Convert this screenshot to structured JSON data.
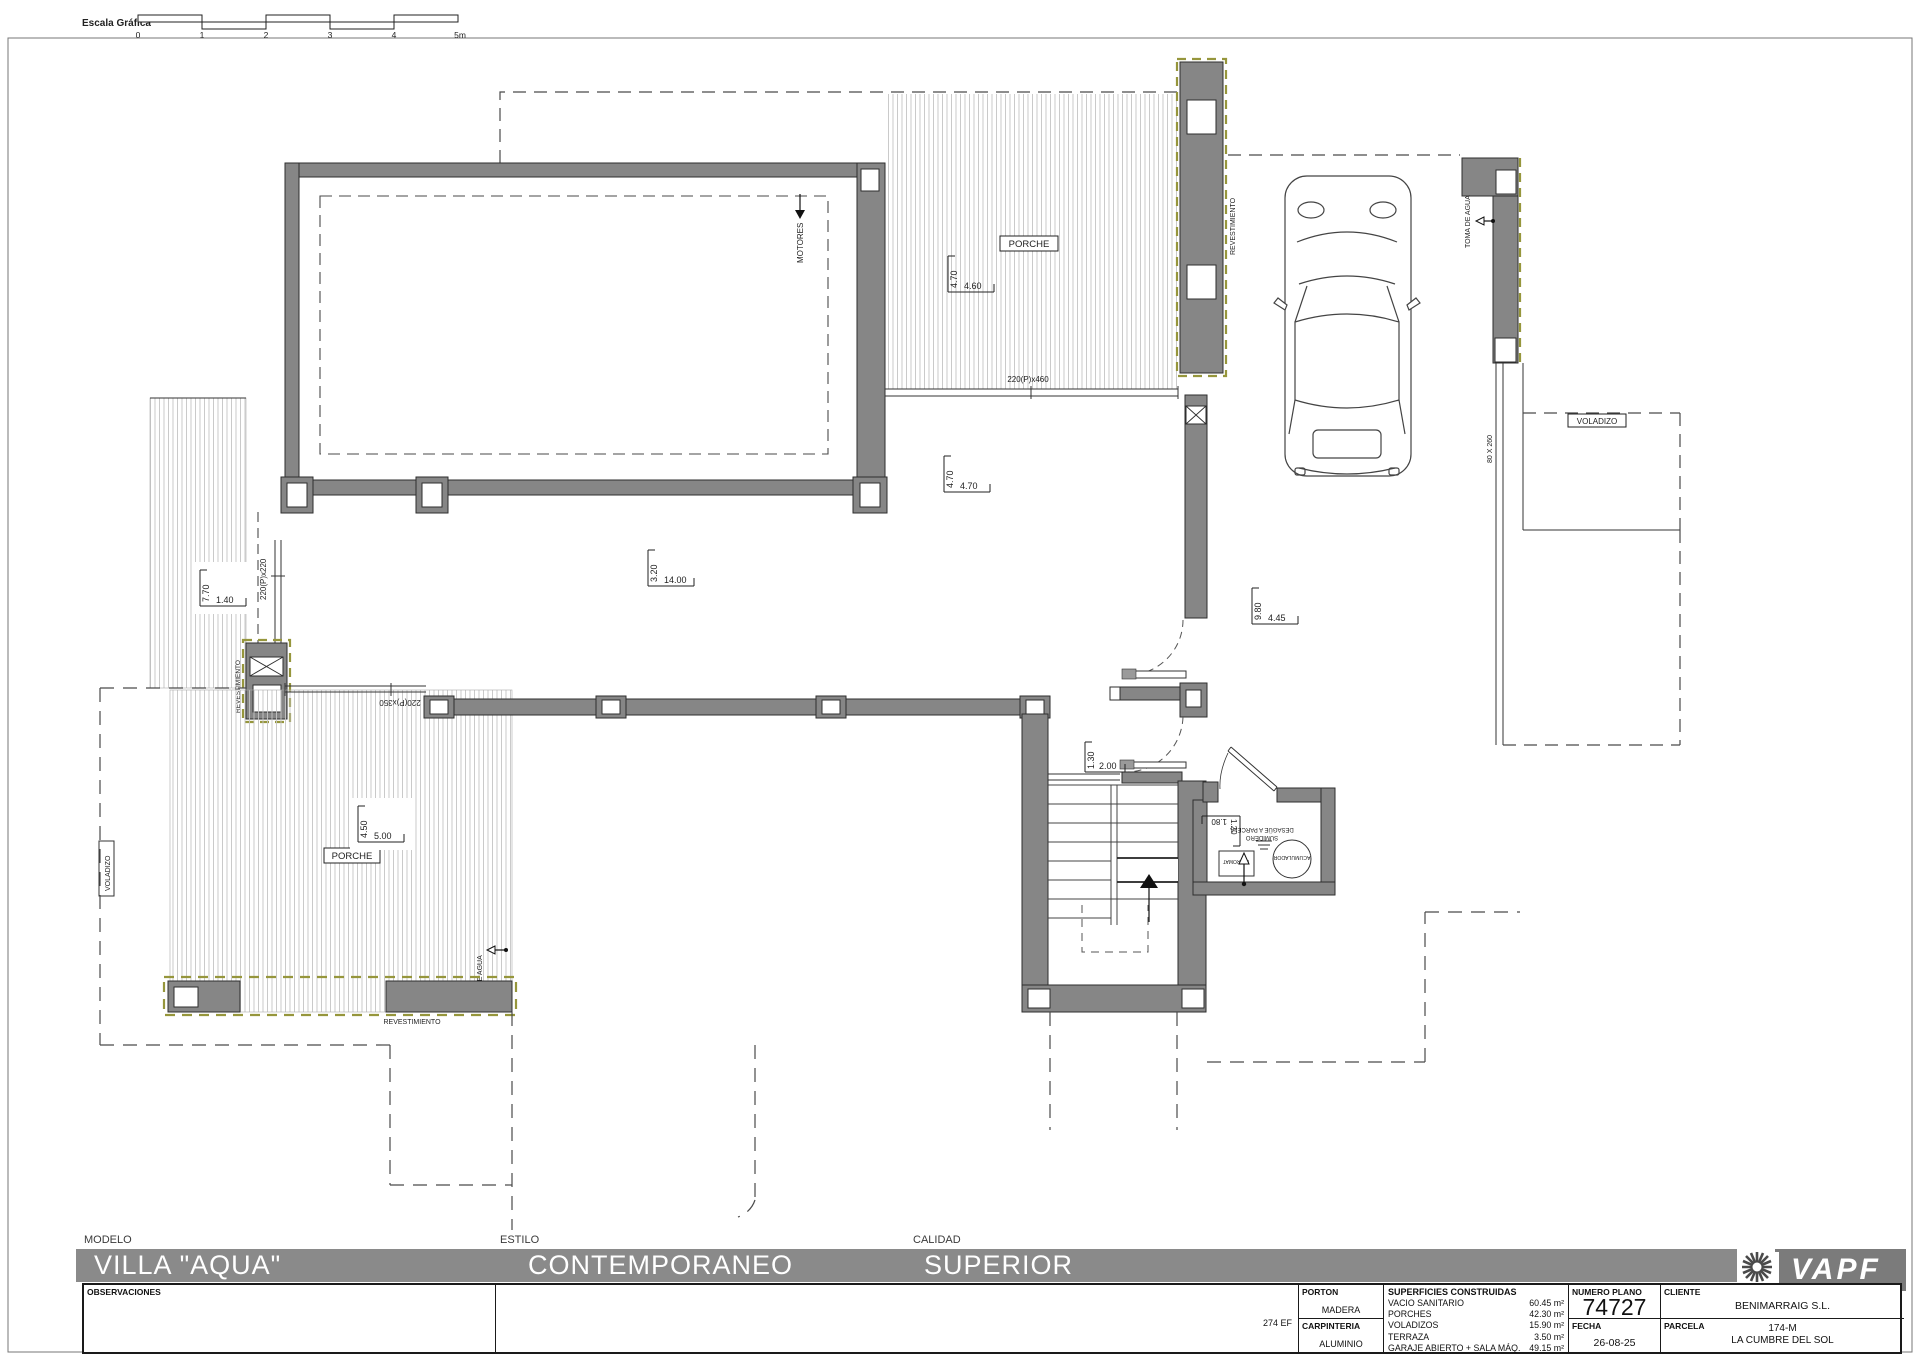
{
  "scale_bar": {
    "label": "Escala Gráfica",
    "ticks": [
      "0",
      "1",
      "2",
      "3",
      "4",
      "5m"
    ]
  },
  "plan": {
    "labels": {
      "porche_top": "PORCHE",
      "porche_lower": "PORCHE",
      "motores": "MOTORES",
      "toma_de_agua_garage": "TOMA DE AGUA",
      "toma_de_agua_porch": "TOMA DE AGUA",
      "revestimiento_right": "REVESTIMIENTO",
      "revestimiento_left": "REVESTIMIENTO",
      "revestimiento_bottom": "REVESTIMIENTO",
      "voladizo_right": "VOLADIZO",
      "voladizo_left": "VOLADIZO",
      "sumidero_line1": "SUMIDERO",
      "sumidero_line2": "DESAGÜE A PARCELA",
      "acumulador": "ACUMULADOR",
      "hidromat": "HIDROMAT",
      "win_220x460": "220(P)x460",
      "win_220x220": "220(P)x220",
      "win_220x350": "220(P)x350",
      "win_80x260": "80 X 260"
    },
    "dimensions": {
      "porch_top": {
        "v": "4.70",
        "h": "4.60"
      },
      "terrace_mid": {
        "v": "4.70",
        "h": "4.70"
      },
      "pool_terrace": {
        "v": "3.20",
        "h": "14.00"
      },
      "left_terrace": {
        "v": "7.70",
        "h": "1.40"
      },
      "porch_left": {
        "v": "4.50",
        "h": "5.00"
      },
      "entry": {
        "v": "9.80",
        "h": "4.45"
      },
      "hall": {
        "v": "1.30",
        "h": "2.00"
      },
      "machine_room": {
        "v": "1.20",
        "h": "1.80"
      }
    }
  },
  "title_block": {
    "modelo_label": "MODELO",
    "modelo": "VILLA \"AQUA\"",
    "estilo_label": "ESTILO",
    "estilo": "CONTEMPORANEO",
    "calidad_label": "CALIDAD",
    "calidad": "SUPERIOR",
    "observaciones_label": "OBSERVACIONES",
    "ref_code": "274 EF",
    "porton_label": "PORTON",
    "porton": "MADERA",
    "carpinteria_label": "CARPINTERIA",
    "carpinteria": "ALUMINIO",
    "superficies_label": "SUPERFICIES CONSTRUIDAS",
    "superficies": [
      {
        "name": "VACIO SANITARIO",
        "value": "60.45 m²"
      },
      {
        "name": "PORCHES",
        "value": "42.30 m²"
      },
      {
        "name": "VOLADIZOS",
        "value": "15.90 m²"
      },
      {
        "name": "TERRAZA",
        "value": "3.50 m²"
      },
      {
        "name": "GARAJE ABIERTO + SALA MÁQ.",
        "value": "49.15 m²"
      }
    ],
    "numero_plano_label": "NUMERO PLANO",
    "numero_plano": "74727",
    "fecha_label": "FECHA",
    "fecha": "26-08-25",
    "cliente_label": "CLIENTE",
    "cliente": "BENIMARRAIG S.L.",
    "parcela_label": "PARCELA",
    "parcela_line1": "174-M",
    "parcela_line2": "LA CUMBRE DEL SOL",
    "brand": "VAPF"
  }
}
